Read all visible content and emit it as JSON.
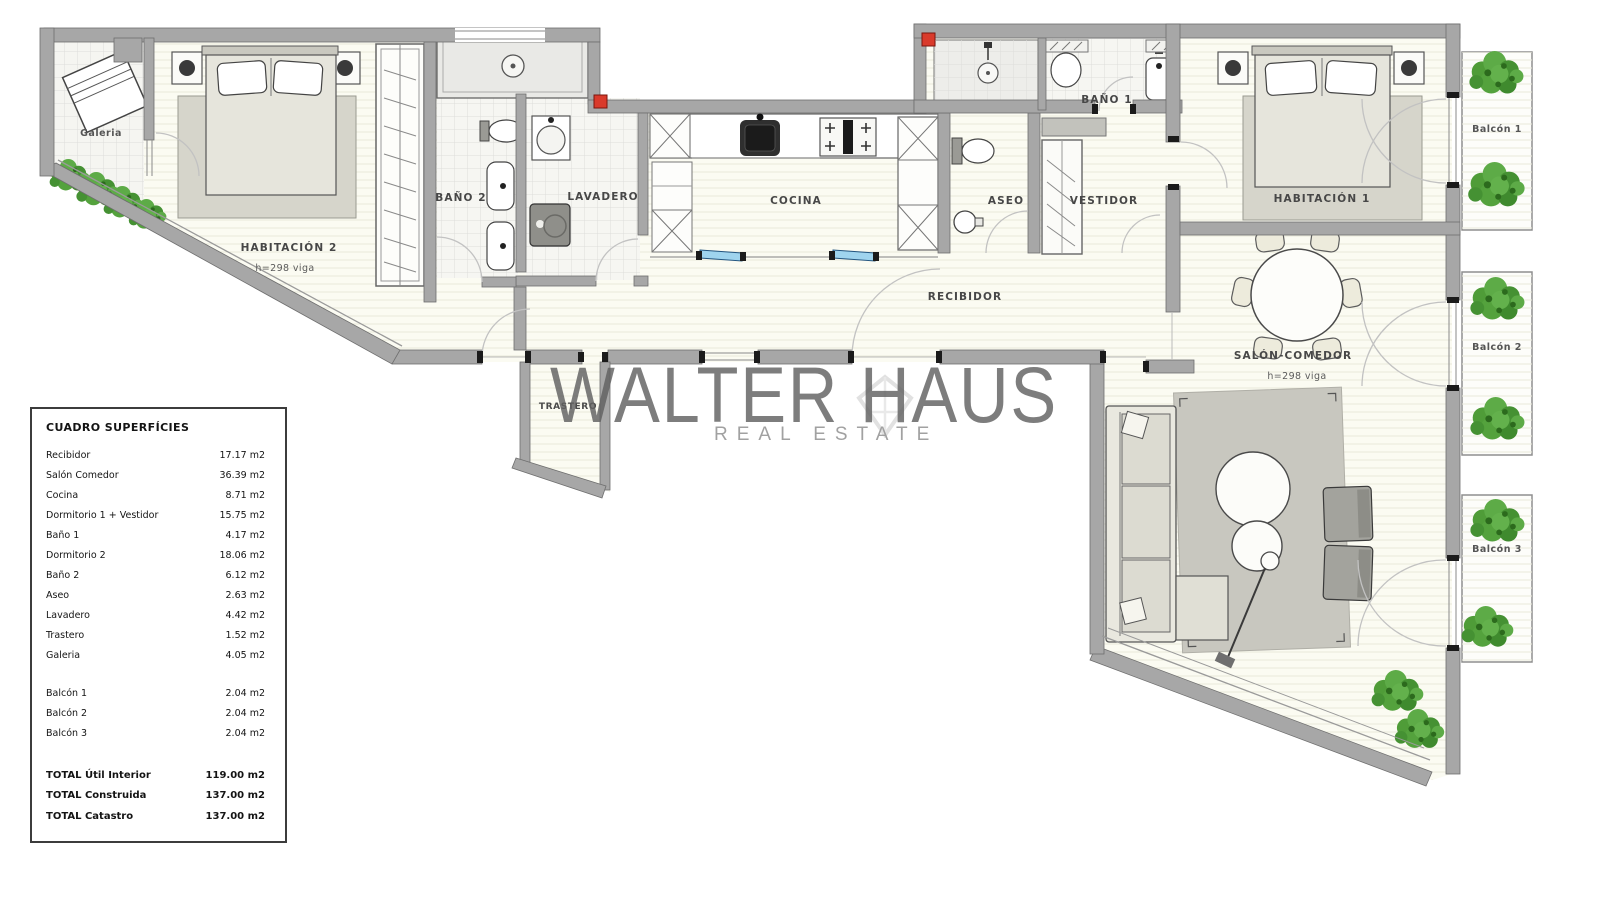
{
  "brand": {
    "watermark_line1": "WALTER HAUS",
    "watermark_line2": "REAL ESTATE"
  },
  "plan": {
    "rooms": {
      "galeria": "Galeria",
      "habitacion2": "HABITACIÓN 2",
      "bano2": "BAÑO 2",
      "lavadero": "LAVADERO",
      "cocina": "COCINA",
      "aseo": "ASEO",
      "bano1": "BAÑO 1",
      "vestidor": "VESTIDOR",
      "habitacion1": "HABITACIÓN 1",
      "recibidor": "RECIBIDOR",
      "salon_comedor": "SALÓN-COMEDOR",
      "trastero": "TRASTERO",
      "balcon1": "Balcón 1",
      "balcon2": "Balcón 2",
      "balcon3": "Balcón 3"
    },
    "notes": {
      "beam": "h=298 viga"
    },
    "colors": {
      "wall_gray": "#a7a7a7",
      "plant_green": "#4f9c38",
      "marker_red": "#d93a2b",
      "slider_blue": "#9fd4ee",
      "watermark_gray": "#616161"
    }
  },
  "surfaces_table": {
    "title": "CUADRO SUPERFÍCIES",
    "rows": [
      {
        "label": "Recibidor",
        "value": "17.17 m2"
      },
      {
        "label": "Salón Comedor",
        "value": "36.39 m2"
      },
      {
        "label": "Cocina",
        "value": "8.71 m2"
      },
      {
        "label": "Dormitorio 1 + Vestidor",
        "value": "15.75 m2"
      },
      {
        "label": "Baño 1",
        "value": "4.17 m2"
      },
      {
        "label": "Dormitorio 2",
        "value": "18.06 m2"
      },
      {
        "label": "Baño 2",
        "value": "6.12 m2"
      },
      {
        "label": "Aseo",
        "value": "2.63 m2"
      },
      {
        "label": "Lavadero",
        "value": "4.42 m2"
      },
      {
        "label": "Trastero",
        "value": "1.52 m2"
      },
      {
        "label": "Galeria",
        "value": "4.05 m2"
      }
    ],
    "balcony_rows": [
      {
        "label": "Balcón 1",
        "value": "2.04 m2"
      },
      {
        "label": "Balcón 2",
        "value": "2.04 m2"
      },
      {
        "label": "Balcón 3",
        "value": "2.04 m2"
      }
    ],
    "total_rows": [
      {
        "label": "TOTAL Útil Interior",
        "value": "119.00 m2"
      },
      {
        "label": "TOTAL Construida",
        "value": "137.00 m2"
      },
      {
        "label": "TOTAL Catastro",
        "value": "137.00 m2"
      }
    ]
  }
}
